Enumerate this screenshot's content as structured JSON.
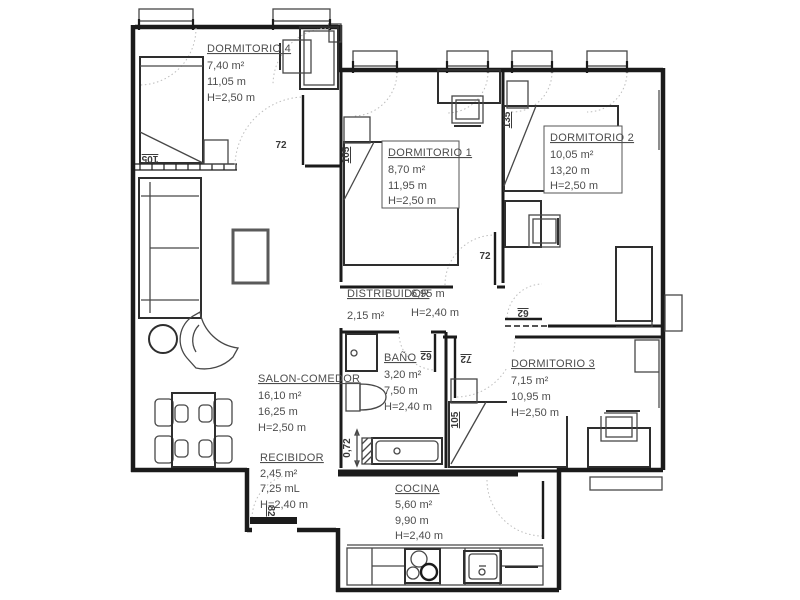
{
  "rooms": {
    "dormitorio_4": {
      "name": "DORMITORIO 4",
      "area": "7,40 m²",
      "perimeter": "11,05 m",
      "ceiling": "H=2,50 m"
    },
    "dormitorio_1": {
      "name": "DORMITORIO 1",
      "area": "8,70 m²",
      "perimeter": "11,95 m",
      "ceiling": "H=2,50 m"
    },
    "dormitorio_2": {
      "name": "DORMITORIO 2",
      "area": "10,05 m²",
      "perimeter": "13,20 m",
      "ceiling": "H=2,50 m"
    },
    "distribuidor": {
      "name": "DISTRIBUIDOR",
      "area": "2,15 m²",
      "perimeter": "6,95 m",
      "ceiling": "H=2,40 m"
    },
    "bano": {
      "name": "BAÑO",
      "area": "3,20 m²",
      "perimeter": "7,50 m",
      "ceiling": "H=2,40 m"
    },
    "dormitorio_3": {
      "name": "DORMITORIO 3",
      "area": "7,15 m²",
      "perimeter": "10,95 m",
      "ceiling": "H=2,50 m"
    },
    "salon_comedor": {
      "name": "SALON-COMEDOR",
      "area": "16,10 m²",
      "perimeter": "16,25 m",
      "ceiling": "H=2,50 m"
    },
    "recibidor": {
      "name": "RECIBIDOR",
      "area": "2,45 m²",
      "perimeter": "7,25 mL",
      "ceiling": "H=2,40 m"
    },
    "cocina": {
      "name": "COCINA",
      "area": "5,60 m²",
      "perimeter": "9,90 m",
      "ceiling": "H=2,40 m"
    }
  },
  "dimension_labels": {
    "dorm4_door": "72",
    "dorm4_bed": "105",
    "dorm1_bed": "105",
    "dorm1_door": "72",
    "dorm2_bed": "135",
    "dorm2_door": "62",
    "bano_door": "62",
    "dorm3_door": "72",
    "dorm3_bed": "105",
    "bathtub_width": "0,72",
    "entrance_door": "82"
  },
  "colors": {
    "wall": "#1b1b1b",
    "furniture": "#474747",
    "text": "#4d4d4d",
    "swing_arc": "#bdbdbd",
    "background": "#ffffff"
  }
}
